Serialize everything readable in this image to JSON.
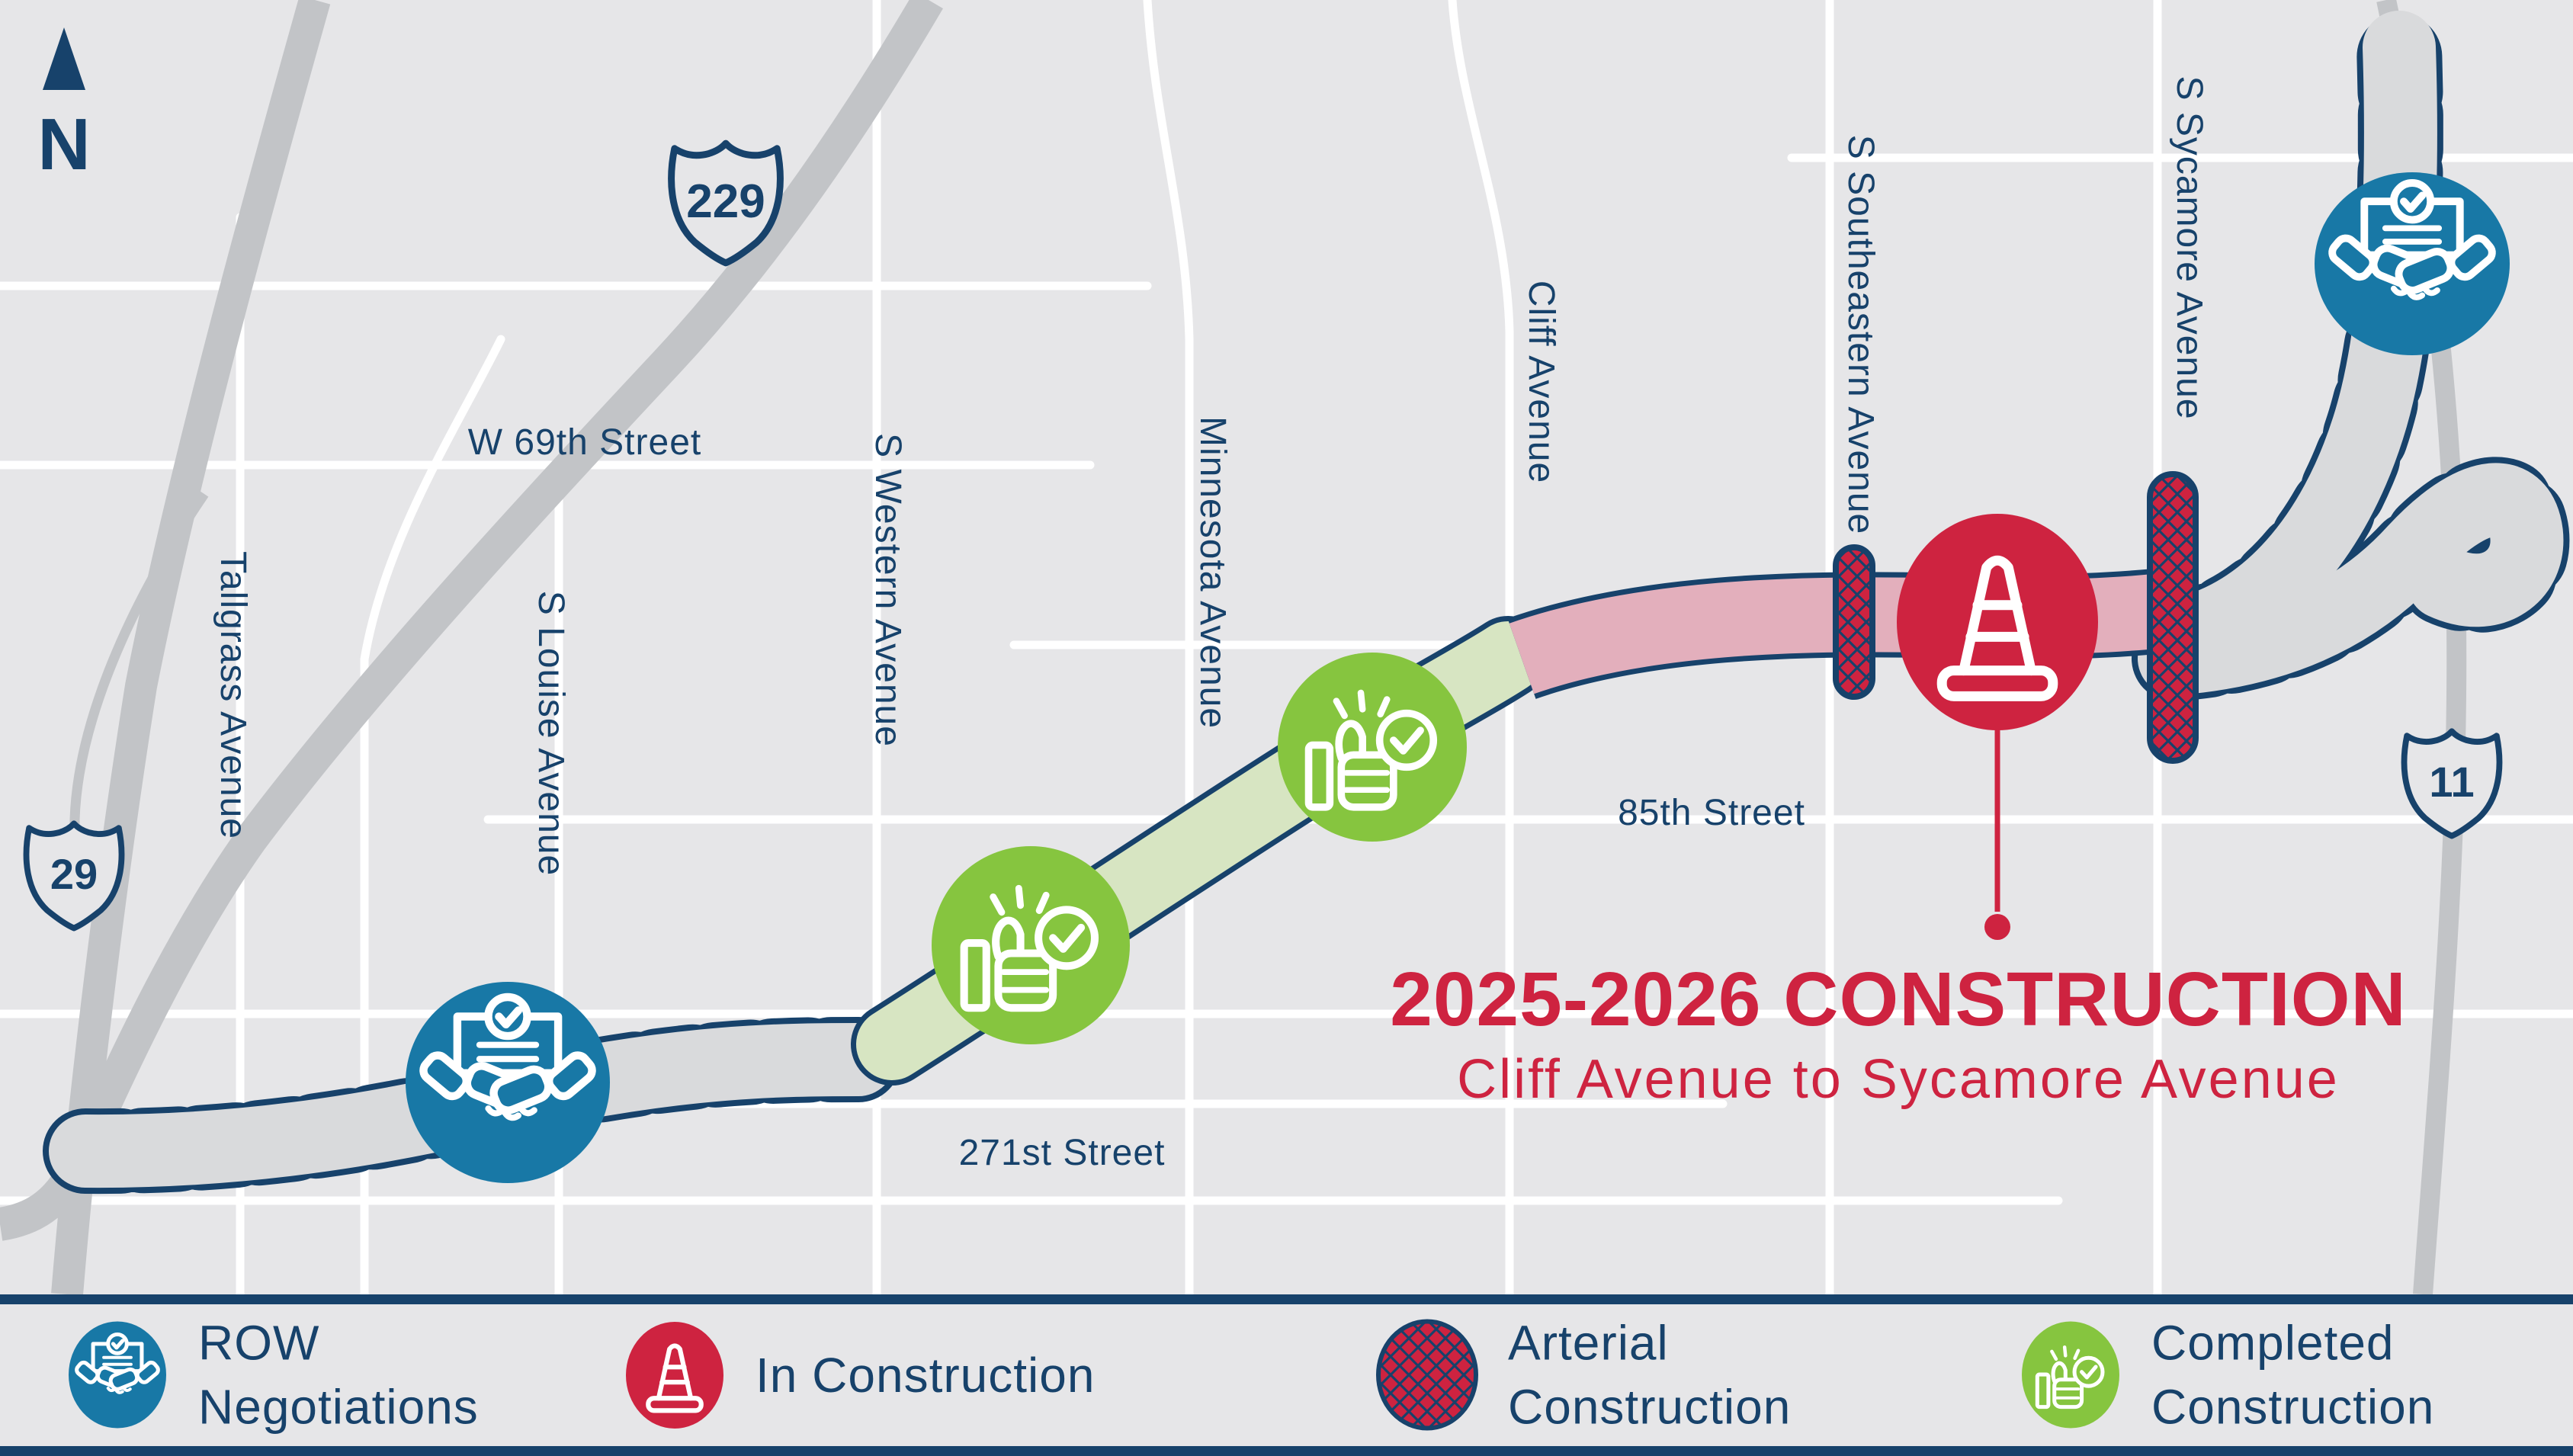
{
  "map": {
    "north": "N",
    "shields": {
      "route_229": "229",
      "route_29": "29",
      "route_11": "11"
    },
    "streets": {
      "w69th": "W 69th Street",
      "tallgrass": "Tallgrass Avenue",
      "louise": "S Louise Avenue",
      "western": "S Western Avenue",
      "minnesota": "Minnesota Avenue",
      "cliff": "Cliff Avenue",
      "southeastern": "S Southeastern Avenue",
      "sycamore": "S Sycamore Avenue",
      "st85": "85th Street",
      "st271": "271st Street"
    },
    "callout": {
      "title": "2025-2026 CONSTRUCTION",
      "subtitle": "Cliff Avenue to Sycamore Avenue"
    }
  },
  "legend": {
    "items": [
      {
        "id": "row-negotiations",
        "label": "ROW Negotiations",
        "icon": "handshake-icon",
        "color": "#1878a6"
      },
      {
        "id": "in-construction",
        "label": "In Construction",
        "icon": "traffic-cone-icon",
        "color": "#ce2340"
      },
      {
        "id": "arterial-construction",
        "label": "Arterial Construction",
        "icon": "crosshatch-icon",
        "color": "#ce2340"
      },
      {
        "id": "completed-construction",
        "label": "Completed Construction",
        "icon": "thumbs-up-icon",
        "color": "#86c53f"
      }
    ]
  },
  "colors": {
    "navy": "#17426b",
    "red": "#ce2340",
    "blue": "#1878a6",
    "green": "#86c53f",
    "green_fill": "#d7e5c2",
    "pink_fill": "#e3afbc",
    "highway_gray": "#c2c4c7",
    "row_gray": "#d9dadc",
    "background": "#e6e6e8"
  }
}
